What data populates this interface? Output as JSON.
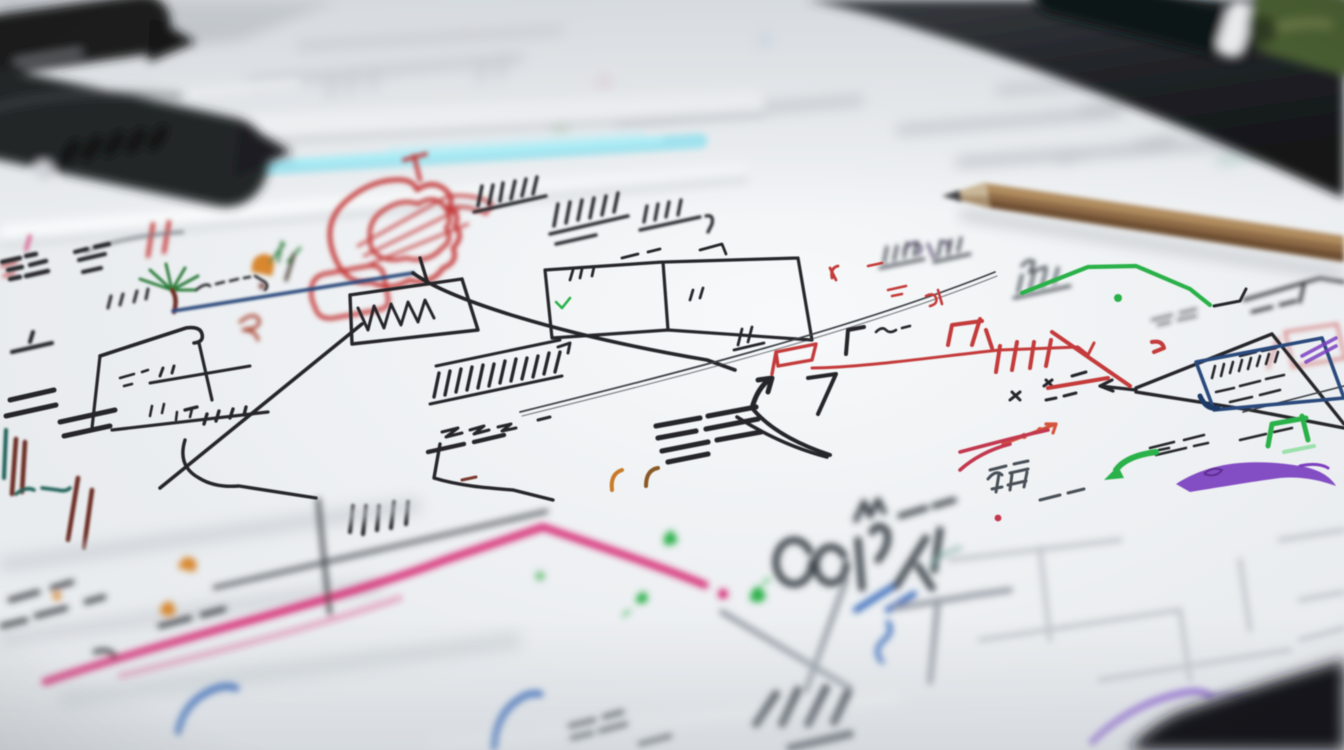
{
  "scene": {
    "type": "photograph",
    "subject": "extreme close-up of hand-drawn flowchart sketches in colored marker on white paper sheets, shallow depth of field, markers and pencil resting on the page",
    "objects": [
      {
        "name": "black-marker-upper",
        "color": "#1a1c1f"
      },
      {
        "name": "black-marker-lower",
        "color": "#232528"
      },
      {
        "name": "black-pen",
        "color": "#101214"
      },
      {
        "name": "green-marker",
        "color": "#4a5d33"
      },
      {
        "name": "wooden-pencil",
        "color": "#8f6b46"
      },
      {
        "name": "paper-sheet",
        "color": "#edeff2"
      },
      {
        "name": "desk-surface",
        "color": "#1e2023"
      }
    ]
  },
  "palette": {
    "black": "#26282c",
    "inkdark": "#3a3f45",
    "slate": "#4a5057",
    "navy": "#2a4a7b",
    "blue": "#2f63b8",
    "skyblue": "#8fe0ee",
    "red": "#c43a3a",
    "crimson": "#c23750",
    "orangered": "#d4553a",
    "orange": "#d8872e",
    "maroon": "#6b2a24",
    "teal": "#1e5f55",
    "green": "#2cb14a",
    "darkgreen": "#2e7d3c",
    "lightgreen": "#7bd98e",
    "pink": "#d6246e",
    "purple": "#7b3fbf",
    "lavender": "#8a5fd0",
    "gray": "#9aa0a8",
    "lightgray": "#c3c8cd",
    "fade": "#b4b9c0",
    "violetink": "#5a4a6e",
    "woodlight": "#c9b797",
    "woodtop": "#b08c5f",
    "woodshade": "#6e4f33",
    "graphite": "#3f4145"
  }
}
